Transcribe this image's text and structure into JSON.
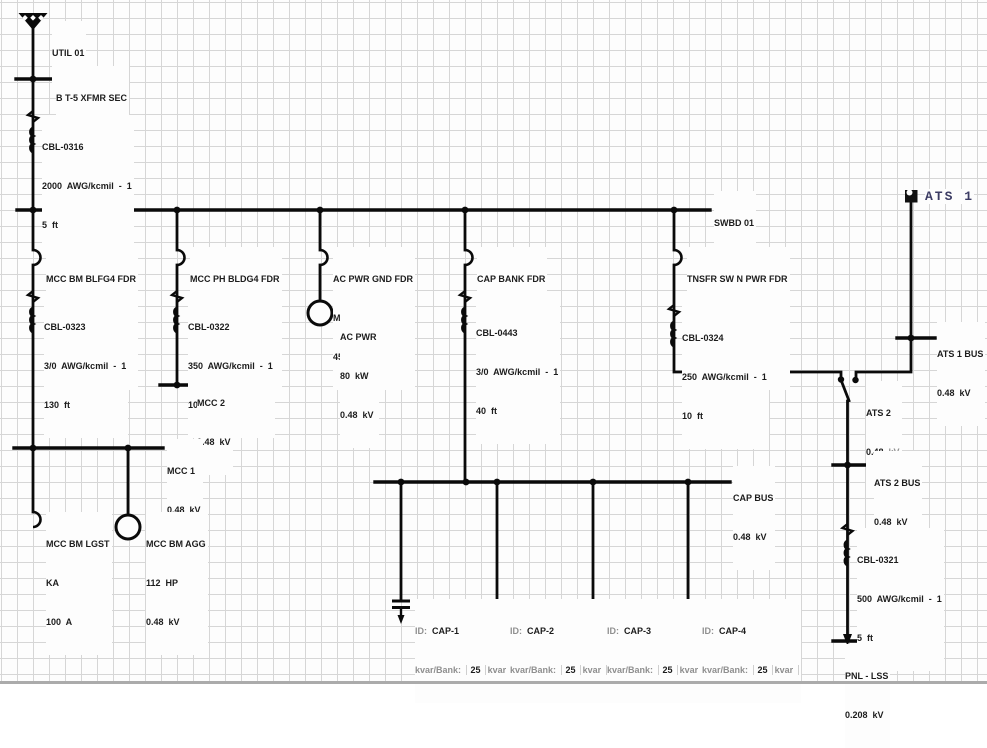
{
  "colors": {
    "line": "#0a0a0a",
    "text": "#1c1c1c",
    "muted": "#8f8f8f",
    "grid": "#d6d6d6",
    "ats_label": "#3c3c64"
  },
  "nodes": {
    "util01": {
      "label": "UTIL 01"
    },
    "xfmr_sec_bus": {
      "name": "B T-5 XFMR SEC",
      "kv": "0.48  kV"
    },
    "cbl0316": {
      "id": "CBL-0316",
      "size": "2000  AWG/kcmil  -  1",
      "length": "5  ft"
    },
    "swbd01": {
      "name": "SWBD 01",
      "kv": "0.48  kV"
    },
    "fdr_mcc_bm_blfg4": {
      "name": "MCC BM BLFG4 FDR",
      "type": "KA",
      "amps": "175  A"
    },
    "cbl0323": {
      "id": "CBL-0323",
      "size": "3/0  AWG/kcmil  -  1",
      "length": "130  ft"
    },
    "fdr_mcc_ph_bldg4": {
      "name": "MCC PH BLDG4 FDR",
      "type": "LA",
      "amps": "300  A"
    },
    "cbl0322": {
      "id": "CBL-0322",
      "size": "350  AWG/kcmil  -  1",
      "length": "100  ft"
    },
    "mcc2": {
      "name": "MCC 2",
      "kv": "0.48  kV"
    },
    "fdr_ac_pwr_gnd": {
      "name": "AC PWR GND FDR",
      "type": "MA",
      "amps": "450  A"
    },
    "ac_pwr": {
      "name": "AC PWR",
      "kw": "80  kW",
      "kv": "0.48  kV"
    },
    "fdr_cap_bank": {
      "name": "CAP BANK FDR",
      "type": "LA",
      "amps": "400  A"
    },
    "cbl0443": {
      "id": "CBL-0443",
      "size": "3/0  AWG/kcmil  -  1",
      "length": "40  ft"
    },
    "fdr_tnsfr": {
      "name": "TNSFR SW N PWR FDR",
      "type": "MA",
      "amps": "600  A"
    },
    "cbl0324": {
      "id": "CBL-0324",
      "size": "250  AWG/kcmil  -  1",
      "length": "10  ft"
    },
    "mcc1": {
      "name": "MCC 1",
      "kv": "0.48  kV"
    },
    "mcc_bm_lgst": {
      "name": "MCC BM LGST",
      "type": "KA",
      "amps": "100  A"
    },
    "mcc_bm_agg": {
      "name": "MCC BM AGG",
      "hp": "112  HP",
      "kv": "0.48  kV"
    },
    "cap_bus": {
      "name": "CAP BUS",
      "kv": "0.48  kV"
    },
    "ats1": {
      "label": "ATS 1"
    },
    "ats1_bus": {
      "name": "ATS 1 BUS",
      "kv": "0.48  kV"
    },
    "ats2": {
      "name": "ATS 2",
      "kv_value": "0.48",
      "kv_unit": "kV"
    },
    "ats2_bus": {
      "name": "ATS 2 BUS",
      "kv": "0.48  kV"
    },
    "cbl0321": {
      "id": "CBL-0321",
      "size": "500  AWG/kcmil  -  1",
      "length": "5  ft"
    },
    "pnl_lss": {
      "name": "PNL - LSS",
      "kv": "0.208  kV"
    }
  },
  "caps": [
    {
      "id_label": "ID:",
      "id": "CAP-1",
      "kvar_label": "kvar/Bank:",
      "kvar": "25",
      "unit": "kvar"
    },
    {
      "id_label": "ID:",
      "id": "CAP-2",
      "kvar_label": "kvar/Bank:",
      "kvar": "25",
      "unit": "kvar"
    },
    {
      "id_label": "ID:",
      "id": "CAP-3",
      "kvar_label": "kvar/Bank:",
      "kvar": "25",
      "unit": "kvar"
    },
    {
      "id_label": "ID:",
      "id": "CAP-4",
      "kvar_label": "kvar/Bank:",
      "kvar": "25",
      "unit": "kvar"
    }
  ]
}
